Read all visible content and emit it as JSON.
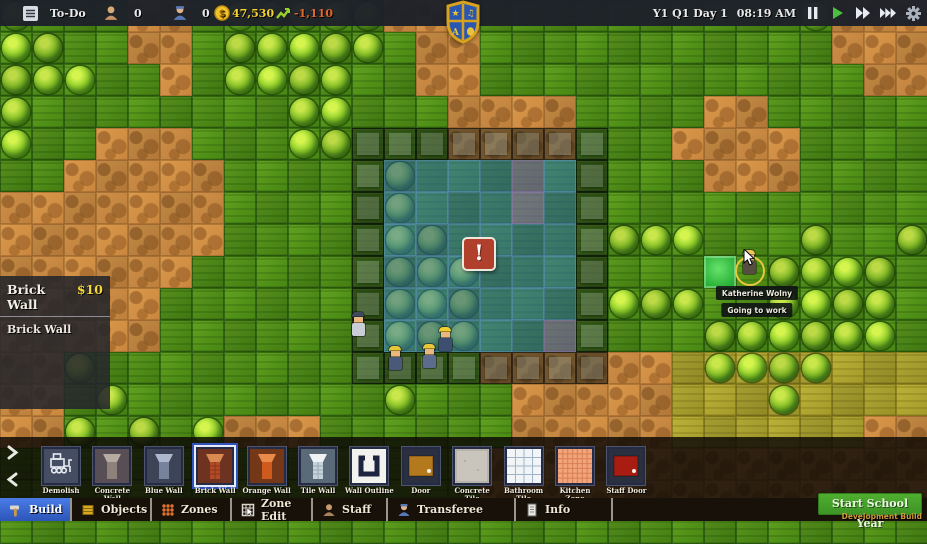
{
  "top_bar": {
    "todo_label": "To-Do",
    "students_count": "0",
    "staff_count": "0",
    "money": "47,530",
    "money_change": "-1,110",
    "date": "Y1 Q1 Day 1",
    "time": "08:19 AM"
  },
  "tooltip_panel": {
    "title": "Brick Wall",
    "price": "$10",
    "description": "Brick Wall"
  },
  "map": {
    "tile_size": 32,
    "cols": 29,
    "legend": {
      "g": {
        "name": "grass",
        "base": "t-g"
      },
      "G": {
        "name": "bush",
        "base": "t-g",
        "bush": true
      },
      "d": {
        "name": "dirt",
        "base": "t-d"
      },
      "y": {
        "name": "dry-grass",
        "base": "t-y"
      },
      "Y": {
        "name": "bush",
        "base": "t-y",
        "bush": true
      },
      "o": {
        "name": "wall-blueprint",
        "base": "t-g",
        "ov": "ov-o"
      },
      "O": {
        "name": "wall-blueprint",
        "base": "t-d",
        "ov": "ov-o"
      },
      "w": {
        "name": "room-blueprint",
        "base": "t-g",
        "ov": "ov-w"
      },
      "W": {
        "name": "room-blueprint",
        "base": "t-g",
        "bush": true,
        "ov": "ov-w"
      },
      "p": {
        "name": "zone-blueprint",
        "base": "t-g",
        "ov": "ov-p"
      }
    },
    "rows": [
      "GgggddgGGGGGdddggggggggggGddd",
      "GGggddgGGGGGgddgggggggggggddd",
      "GGGggdgGGGGggddggggggggggggdd",
      "GggggggggGGgggddddggggddggggg",
      "GggdddgggGGoooOOOOoggddddgggg",
      "ggdddddggggoWwwwpwogggdddgggg",
      "dddddddggggoWwwwpwogggggggggg",
      "dddddddggggoWWwwwwoGGGgggGggG",
      "ddddddgggggoWWWwwwogggggGGGGg",
      "dddddggggggoWWWwwwoGGGggGGGGg",
      "dddddggggggoWWWwwpogggGGGGGGg",
      "ddGggggggggooooOOOOddyYYYYyyy",
      "ddgGggggggggGgggdddddyyyYyyyy",
      "ddGgGgGdddggggggdddddyyyyyydd",
      "gggggggggggggggdddddddddddddd",
      "gggggggggggggggdddddddddddddd",
      "ggggggggggggggggggggggggggggg"
    ]
  },
  "entities": {
    "selected_tile": {
      "x": 704,
      "y": 256
    },
    "warning_marker": {
      "x": 462,
      "y": 237,
      "symbol": "!"
    },
    "workers": [
      {
        "x": 350,
        "y": 312,
        "shirt": "#c9ced6",
        "hat": "#3f4a5e"
      },
      {
        "x": 387,
        "y": 346,
        "shirt": "#49597a",
        "hat": "#e9c63a"
      },
      {
        "x": 421,
        "y": 344,
        "shirt": "#5b6c8e",
        "hat": "#e9c63a"
      },
      {
        "x": 437,
        "y": 327,
        "shirt": "#3e4e70",
        "hat": "#f2cd2e"
      }
    ],
    "character": {
      "name": "Katherine Wolny",
      "status": "Going to work",
      "x": 741,
      "y": 250,
      "hair": "#ecc75a",
      "shirt": "#564c42"
    }
  },
  "toolbar": {
    "items": [
      {
        "label": "Demolish",
        "icon": "demolish",
        "c": {
          "bg": "#454d63",
          "fg": "#e8ecf2"
        }
      },
      {
        "label": "Concrete Wall",
        "icon": "wall",
        "c": {
          "bg": "#574f55",
          "top": "#b5aba1",
          "front": "#8d8179"
        }
      },
      {
        "label": "Blue Wall",
        "icon": "wall",
        "c": {
          "bg": "#3d4458",
          "top": "#aeb8cc",
          "front": "#77839d"
        }
      },
      {
        "label": "Brick Wall",
        "icon": "wall",
        "selected": true,
        "c": {
          "bg": "#6e3320",
          "top": "#d98a52",
          "front": "#b14a27",
          "lines": "#8a3418"
        }
      },
      {
        "label": "Orange Wall",
        "icon": "wall",
        "c": {
          "bg": "#743818",
          "top": "#ea8a4a",
          "front": "#cf5a1d"
        }
      },
      {
        "label": "Tile Wall",
        "icon": "wall",
        "c": {
          "bg": "#5a6a78",
          "top": "#eef2f5",
          "front": "#c6d2da",
          "lines": "#98a8b4"
        }
      },
      {
        "label": "Wall Outline",
        "icon": "outline",
        "c": {
          "bg": "#f2f2ee",
          "fg": "#1d2440"
        }
      },
      {
        "label": "Door",
        "icon": "door",
        "c": {
          "bg": "#2a3040",
          "panel": "#b4791c",
          "knob": "#f5f0e6"
        }
      },
      {
        "label": "Concrete Tile",
        "icon": "tile",
        "c": {
          "bg": "#c9c5bc",
          "line": "#a8a49a"
        }
      },
      {
        "label": "Bathroom Tile",
        "icon": "grid",
        "c": {
          "bg": "#f2f5f7",
          "line": "#9fb4c6",
          "n": 4
        }
      },
      {
        "label": "Kitchen Zone",
        "icon": "grid",
        "c": {
          "bg": "#f2a47c",
          "line": "#d87f52",
          "n": 7
        }
      },
      {
        "label": "Staff Door",
        "icon": "door",
        "c": {
          "bg": "#2a3040",
          "panel": "#a81c12",
          "knob": "#f5f0e6"
        }
      }
    ]
  },
  "tabs": [
    {
      "label": "Build",
      "icon": "hammer",
      "selected": true,
      "w": 72
    },
    {
      "label": "Objects",
      "icon": "crate",
      "w": 80
    },
    {
      "label": "Zones",
      "icon": "dots",
      "w": 80
    },
    {
      "label": "Zone Edit",
      "icon": "grid-cursor",
      "w": 81
    },
    {
      "label": "Staff",
      "icon": "person-tan",
      "w": 75
    },
    {
      "label": "Transferee",
      "icon": "person-blue",
      "w": 128
    },
    {
      "label": "Info",
      "icon": "doc",
      "w": 97
    }
  ],
  "footer": {
    "start_button": "Start School Year",
    "dev_build": "Development Build"
  },
  "colors": {
    "money_yellow": "#f5d12e",
    "loss_orange": "#e0662a",
    "selected_tab_blue": "#3566cc",
    "start_green": "#42a32e"
  }
}
